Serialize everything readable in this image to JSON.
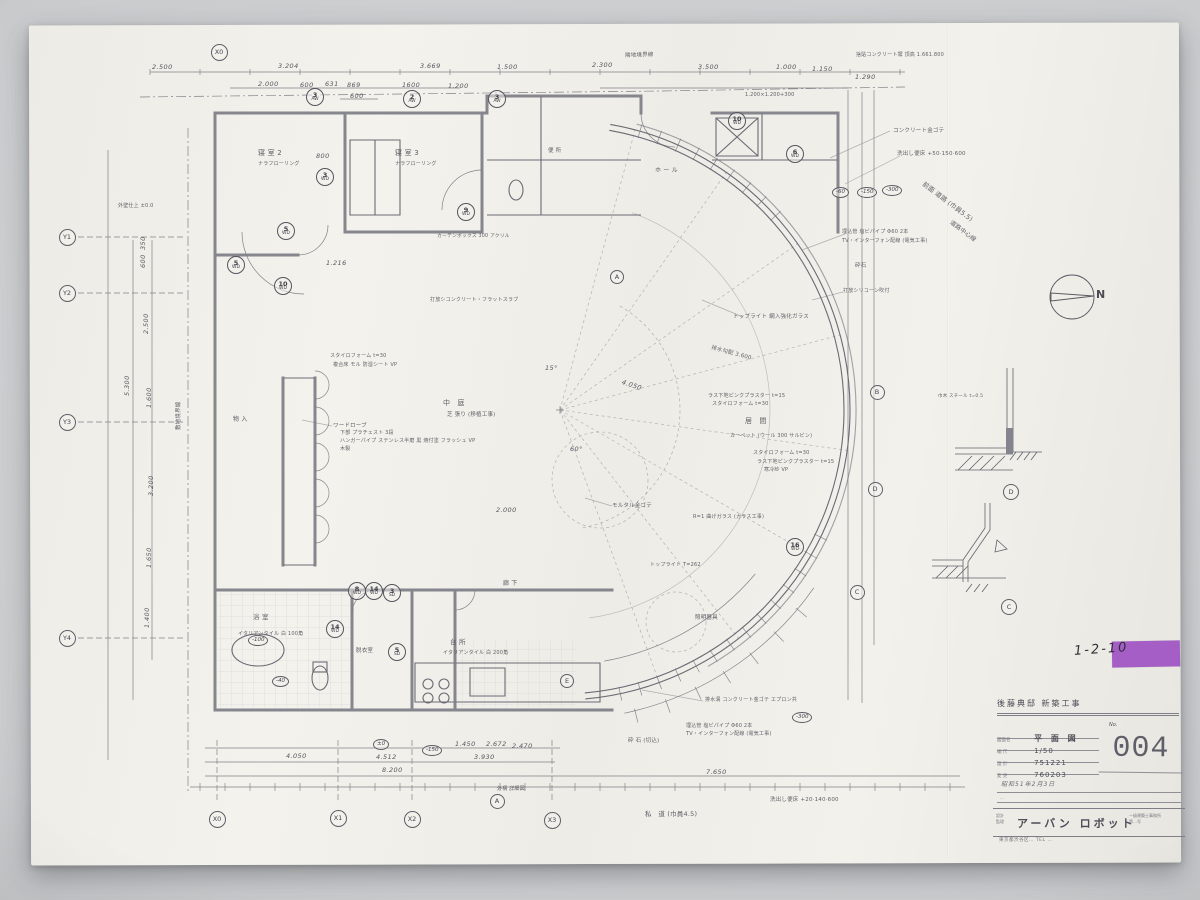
{
  "photo": {
    "sticker_code": "1-2-10",
    "sticker_color": "#a55ec6"
  },
  "north_label": "N",
  "titleblock": {
    "project": "後藤典邸 新築工事",
    "no_label": "No.",
    "no": "004",
    "rows": [
      {
        "label": "図面名",
        "value": "平 面 図"
      },
      {
        "label": "縮 尺",
        "value": "1/50"
      },
      {
        "label": "設 計",
        "value": "751221"
      },
      {
        "label": "変 更",
        "value": "760203"
      }
    ],
    "stamp": "昭和51年2月3日",
    "memo": "…",
    "firm_label": "設計\n監理",
    "firm": "アーバン ロボット",
    "firm_note1": "一級建築士事務所",
    "firm_note2": "第…号",
    "firm_addr": "東京都渋谷区… TEL …"
  },
  "annotations": [
    {
      "x": 625,
      "y": 53,
      "t": "隣地境界線",
      "s": 5.5,
      "r": -2
    },
    {
      "x": 856,
      "y": 53,
      "t": "捨貼コンクリート塀 頂高 1.661.800",
      "s": 5
    },
    {
      "x": 893,
      "y": 128,
      "t": "コンクリート金ゴテ",
      "s": 5.5
    },
    {
      "x": 897,
      "y": 151,
      "t": "洗出し便床 +50·150·600",
      "s": 5.5
    },
    {
      "x": 925,
      "y": 181,
      "t": "前面 道路 (巾員5.5)",
      "s": 6.5,
      "r": 37
    },
    {
      "x": 952,
      "y": 220,
      "t": "道路中心線",
      "s": 6,
      "r": 37
    },
    {
      "x": 842,
      "y": 230,
      "t": "埋込管 塩ビパイプ Φ60 2本",
      "s": 5
    },
    {
      "x": 842,
      "y": 239,
      "t": "TV・インターフォン配線 (電気工事)",
      "s": 5
    },
    {
      "x": 855,
      "y": 263,
      "t": "砕石",
      "s": 5.5
    },
    {
      "x": 843,
      "y": 289,
      "t": "打放シリコーン吹付",
      "s": 5
    },
    {
      "x": 733,
      "y": 314,
      "t": "トップライト 網入強化ガラス",
      "s": 5.5
    },
    {
      "x": 712,
      "y": 345,
      "t": "排水勾配 3.600",
      "s": 5.5,
      "r": 15
    },
    {
      "x": 430,
      "y": 298,
      "t": "打放シコンクリート・フラットスラブ",
      "s": 5
    },
    {
      "x": 330,
      "y": 354,
      "t": "スタイロフォーム t=30",
      "s": 5
    },
    {
      "x": 333,
      "y": 363,
      "t": "複合床 モル 防湿シート VP",
      "s": 5
    },
    {
      "x": 443,
      "y": 400,
      "t": "中　庭",
      "s": 7
    },
    {
      "x": 447,
      "y": 412,
      "t": "芝 張り (移植工事)",
      "s": 5.5
    },
    {
      "x": 333,
      "y": 423,
      "t": "ワードローブ",
      "s": 5.5
    },
    {
      "x": 340,
      "y": 431,
      "t": "下部 プラチェスト 3段",
      "s": 5
    },
    {
      "x": 340,
      "y": 439,
      "t": "ハンガーパイプ ステンレス半磨 黒 焼付塗 フラッシュ VP",
      "s": 5
    },
    {
      "x": 340,
      "y": 447,
      "t": "木製",
      "s": 5
    },
    {
      "x": 745,
      "y": 418,
      "t": "居　間",
      "s": 7
    },
    {
      "x": 730,
      "y": 434,
      "t": "カーペット (ウール 300 サルビン)",
      "s": 5
    },
    {
      "x": 708,
      "y": 394,
      "t": "ラス下地ピンクプラスター t=15",
      "s": 5
    },
    {
      "x": 712,
      "y": 402,
      "t": "スタイロフォーム t=30",
      "s": 5
    },
    {
      "x": 753,
      "y": 451,
      "t": "スタイロフォーム t=30",
      "s": 5
    },
    {
      "x": 757,
      "y": 460,
      "t": "ラス下地ピンクプラスター t=15",
      "s": 5
    },
    {
      "x": 764,
      "y": 468,
      "t": "寒冷紗 VP",
      "s": 5
    },
    {
      "x": 612,
      "y": 503,
      "t": "モルタル金ゴテ",
      "s": 5.5
    },
    {
      "x": 693,
      "y": 515,
      "t": "R=1 曲げガラス (ガラス工事)",
      "s": 5
    },
    {
      "x": 650,
      "y": 563,
      "t": "トップライト T=262",
      "s": 5
    },
    {
      "x": 695,
      "y": 615,
      "t": "照明器具",
      "s": 5.5
    },
    {
      "x": 628,
      "y": 738,
      "t": "砕 石 (切込)",
      "s": 5.5
    },
    {
      "x": 705,
      "y": 698,
      "t": "排水溝 コンクリート金ゴテ エプロン共",
      "s": 5
    },
    {
      "x": 686,
      "y": 724,
      "t": "埋込管 塩ビパイプ Φ60 2本",
      "s": 5
    },
    {
      "x": 686,
      "y": 732,
      "t": "TV・インターフォン配線 (電気工事)",
      "s": 5
    },
    {
      "x": 770,
      "y": 797,
      "t": "洗出し便床 +20·140·600",
      "s": 5.5
    },
    {
      "x": 645,
      "y": 811,
      "t": "私　道 (巾員4.5)",
      "s": 6.5
    },
    {
      "x": 176,
      "y": 430,
      "t": "敷地境界線",
      "s": 5.5,
      "r": -90
    },
    {
      "x": 118,
      "y": 204,
      "t": "外壁仕上 ±0.0",
      "s": 5
    },
    {
      "x": 258,
      "y": 150,
      "t": "寝 室 2",
      "s": 7
    },
    {
      "x": 258,
      "y": 162,
      "t": "ナラフローリング",
      "s": 5
    },
    {
      "x": 395,
      "y": 150,
      "t": "寝 室 3",
      "s": 7
    },
    {
      "x": 395,
      "y": 162,
      "t": "ナラフローリング",
      "s": 5
    },
    {
      "x": 233,
      "y": 417,
      "t": "物 入",
      "s": 6
    },
    {
      "x": 253,
      "y": 614,
      "t": "浴 室",
      "s": 6.5
    },
    {
      "x": 238,
      "y": 632,
      "t": "イタリアンタイル 白 100角",
      "s": 5
    },
    {
      "x": 450,
      "y": 639,
      "t": "台 所",
      "s": 6.5
    },
    {
      "x": 443,
      "y": 651,
      "t": "イタリアンタイル 白 200角",
      "s": 5
    },
    {
      "x": 503,
      "y": 581,
      "t": "廊 下",
      "s": 6
    },
    {
      "x": 356,
      "y": 648,
      "t": "脱衣室",
      "s": 5.5
    },
    {
      "x": 745,
      "y": 93,
      "t": "1.200×1.200+300",
      "s": 5
    },
    {
      "x": 655,
      "y": 168,
      "t": "ホ ー ル",
      "s": 6
    },
    {
      "x": 548,
      "y": 148,
      "t": "便 所",
      "s": 5.5
    },
    {
      "x": 437,
      "y": 234,
      "t": "カーテンボックス 300 アクリル",
      "s": 4.8
    },
    {
      "x": 497,
      "y": 787,
      "t": "外構 詳細図",
      "s": 5
    },
    {
      "x": 938,
      "y": 395,
      "t": "巾木 スチール t=0.5",
      "s": 4.5
    }
  ],
  "dimensions": [
    {
      "x": 152,
      "y": 63,
      "t": "2.500"
    },
    {
      "x": 278,
      "y": 62,
      "t": "3.204"
    },
    {
      "x": 420,
      "y": 62,
      "t": "3.669"
    },
    {
      "x": 497,
      "y": 63,
      "t": "1.500"
    },
    {
      "x": 592,
      "y": 61,
      "t": "2.300"
    },
    {
      "x": 698,
      "y": 63,
      "t": "3.500"
    },
    {
      "x": 776,
      "y": 63,
      "t": "1.000"
    },
    {
      "x": 812,
      "y": 65,
      "t": "1.150"
    },
    {
      "x": 855,
      "y": 73,
      "t": "1.290"
    },
    {
      "x": 258,
      "y": 80,
      "t": "2.000"
    },
    {
      "x": 300,
      "y": 81,
      "t": "600"
    },
    {
      "x": 325,
      "y": 80,
      "t": "631"
    },
    {
      "x": 347,
      "y": 81,
      "t": "869"
    },
    {
      "x": 350,
      "y": 92,
      "t": "600"
    },
    {
      "x": 402,
      "y": 81,
      "t": "1600"
    },
    {
      "x": 448,
      "y": 82,
      "t": "1.200"
    },
    {
      "x": 127,
      "y": 392,
      "t": "5.300",
      "r": -90
    },
    {
      "x": 146,
      "y": 330,
      "t": "2.500",
      "r": -90
    },
    {
      "x": 149,
      "y": 404,
      "t": "1.600",
      "r": -90
    },
    {
      "x": 143,
      "y": 264,
      "t": "600",
      "r": -90
    },
    {
      "x": 143,
      "y": 246,
      "t": "350",
      "r": -90
    },
    {
      "x": 151,
      "y": 492,
      "t": "3.200",
      "r": -90
    },
    {
      "x": 149,
      "y": 564,
      "t": "1.650",
      "r": -90
    },
    {
      "x": 147,
      "y": 624,
      "t": "1.400",
      "r": -90
    },
    {
      "x": 286,
      "y": 752,
      "t": "4.050"
    },
    {
      "x": 376,
      "y": 753,
      "t": "4.512"
    },
    {
      "x": 474,
      "y": 753,
      "t": "3.930"
    },
    {
      "x": 512,
      "y": 742,
      "t": "2.470"
    },
    {
      "x": 382,
      "y": 766,
      "t": "8.200"
    },
    {
      "x": 706,
      "y": 768,
      "t": "7.650"
    },
    {
      "x": 455,
      "y": 740,
      "t": "1.450"
    },
    {
      "x": 486,
      "y": 740,
      "t": "2.672"
    },
    {
      "x": 496,
      "y": 506,
      "t": "2.000"
    },
    {
      "x": 326,
      "y": 259,
      "t": "1.216"
    },
    {
      "x": 622,
      "y": 378,
      "t": "4.050",
      "r": 18
    },
    {
      "x": 316,
      "y": 152,
      "t": "800"
    },
    {
      "x": 545,
      "y": 364,
      "t": "15°"
    },
    {
      "x": 570,
      "y": 445,
      "t": "60°"
    }
  ],
  "tags": [
    {
      "x": 315,
      "y": 97,
      "a": "3",
      "b": "AW"
    },
    {
      "x": 412,
      "y": 99,
      "a": "2",
      "b": "AW"
    },
    {
      "x": 497,
      "y": 99,
      "a": "3",
      "b": "AW"
    },
    {
      "x": 737,
      "y": 121,
      "a": "10",
      "b": "WD"
    },
    {
      "x": 795,
      "y": 154,
      "a": "6",
      "b": "WD"
    },
    {
      "x": 325,
      "y": 177,
      "a": "3",
      "b": "WD"
    },
    {
      "x": 286,
      "y": 231,
      "a": "5",
      "b": "WD"
    },
    {
      "x": 283,
      "y": 286,
      "a": "10",
      "b": "WD"
    },
    {
      "x": 236,
      "y": 265,
      "a": "5",
      "b": "WD"
    },
    {
      "x": 466,
      "y": 212,
      "a": "9",
      "b": "WD"
    },
    {
      "x": 357,
      "y": 591,
      "a": "8",
      "b": "WD"
    },
    {
      "x": 374,
      "y": 591,
      "a": "14",
      "b": "WD"
    },
    {
      "x": 392,
      "y": 593,
      "a": "3",
      "b": "SD"
    },
    {
      "x": 335,
      "y": 629,
      "a": "14",
      "b": "WD"
    },
    {
      "x": 397,
      "y": 652,
      "a": "5",
      "b": "SD"
    },
    {
      "x": 795,
      "y": 547,
      "a": "16",
      "b": "WD"
    }
  ],
  "bubbles": [
    {
      "x": 219,
      "y": 52,
      "l": "X0"
    },
    {
      "x": 217,
      "y": 819,
      "l": "X0"
    },
    {
      "x": 338,
      "y": 818,
      "l": "X1"
    },
    {
      "x": 412,
      "y": 819,
      "l": "X2"
    },
    {
      "x": 552,
      "y": 820,
      "l": "X3"
    },
    {
      "x": 497,
      "y": 801,
      "l": "A",
      "d": 15
    },
    {
      "x": 67,
      "y": 237,
      "l": "Y1"
    },
    {
      "x": 67,
      "y": 293,
      "l": "Y2"
    },
    {
      "x": 67,
      "y": 422,
      "l": "Y3"
    },
    {
      "x": 67,
      "y": 638,
      "l": "Y4"
    },
    {
      "x": 877,
      "y": 392,
      "l": "B",
      "d": 15
    },
    {
      "x": 875,
      "y": 489,
      "l": "D",
      "d": 15
    },
    {
      "x": 857,
      "y": 592,
      "l": "C",
      "d": 15
    },
    {
      "x": 567,
      "y": 681,
      "l": "E",
      "d": 14
    },
    {
      "x": 617,
      "y": 277,
      "l": "A",
      "d": 14
    },
    {
      "x": 1011,
      "y": 492,
      "l": "D",
      "d": 16
    },
    {
      "x": 1009,
      "y": 607,
      "l": "C",
      "d": 16
    }
  ],
  "levels": [
    {
      "x": 842,
      "y": 192,
      "t": "-60"
    },
    {
      "x": 867,
      "y": 192,
      "t": "-150"
    },
    {
      "x": 892,
      "y": 190,
      "t": "-300"
    },
    {
      "x": 802,
      "y": 717,
      "t": "-300"
    },
    {
      "x": 383,
      "y": 744,
      "t": "±0"
    },
    {
      "x": 432,
      "y": 750,
      "t": "-150"
    },
    {
      "x": 258,
      "y": 640,
      "t": "-100"
    },
    {
      "x": 282,
      "y": 681,
      "t": "-40"
    }
  ]
}
